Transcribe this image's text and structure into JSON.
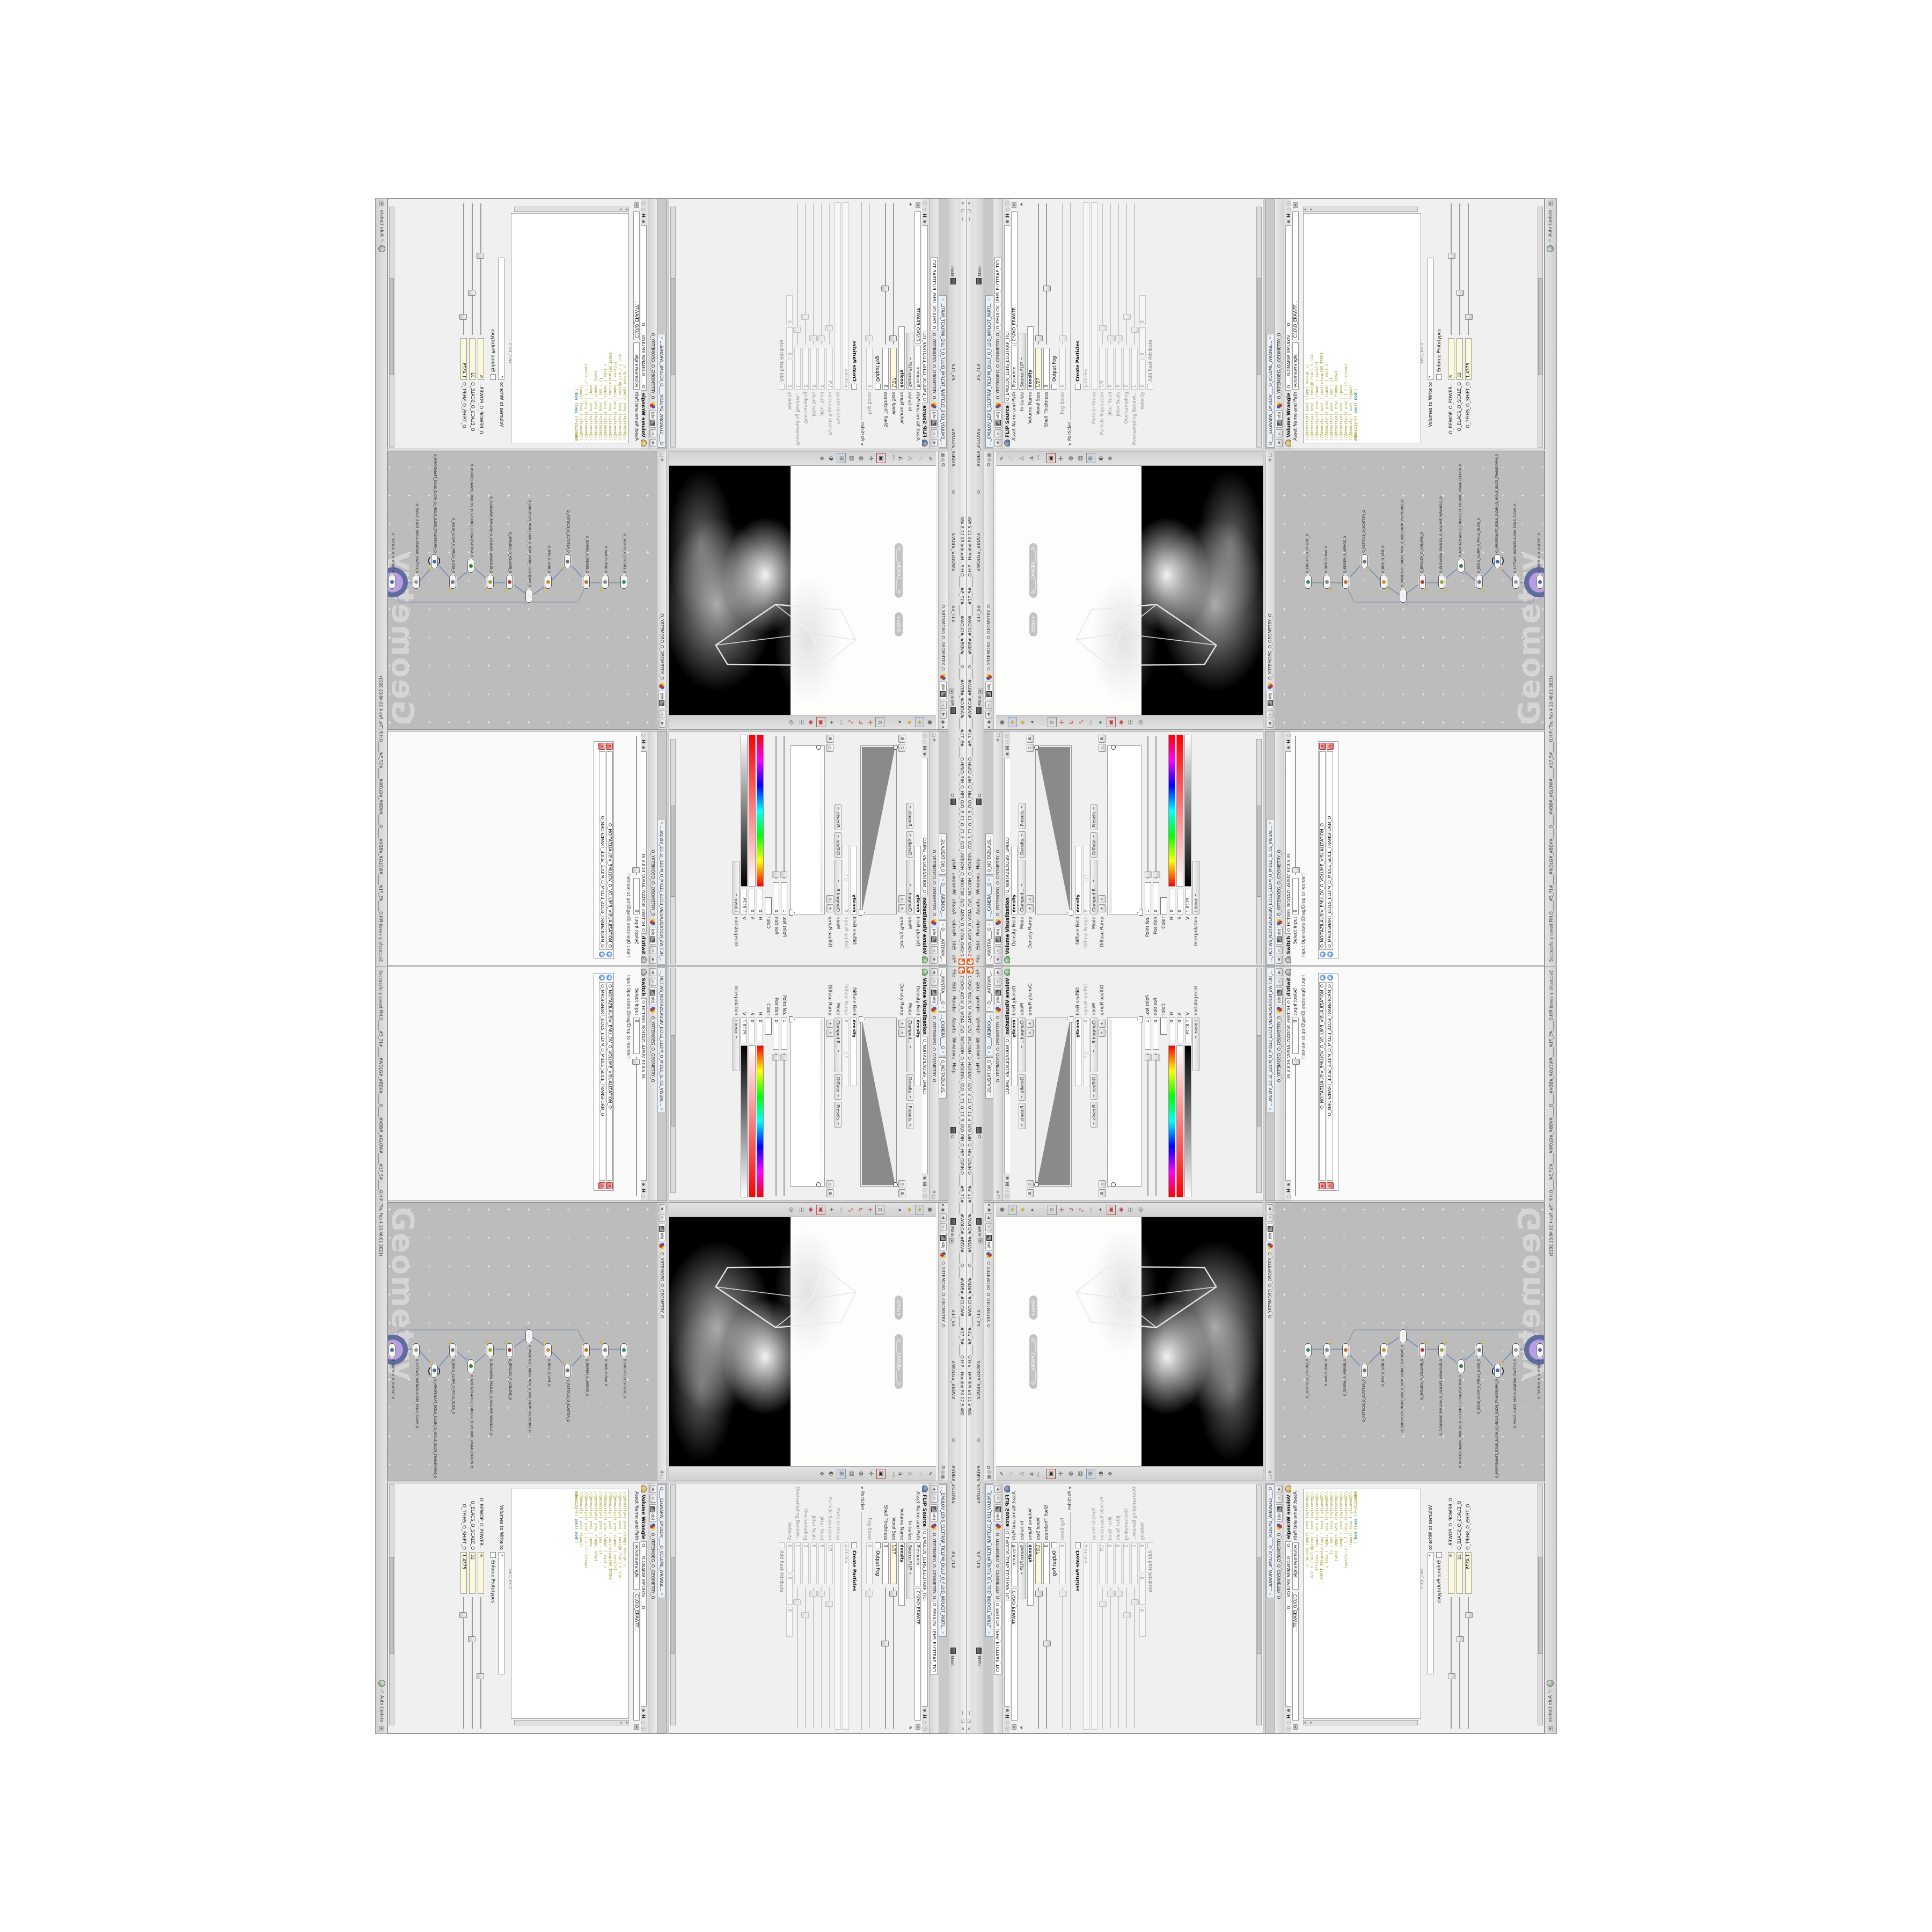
{
  "colors": {
    "orange": "#e8641b",
    "halo_outer": "#5e6c9e",
    "halo_inner": "#b79ee0",
    "code": "#9d9d29",
    "code_keyword": "#2e8fa3",
    "yellow_field": "#fcf9d8",
    "net_bg": "#bcbcbc",
    "accent_tab": "#e9f0f7"
  },
  "title": {
    "text": "C:\\O\\O_AIDIV_O_VIDIA_O\\O_INIDUOH_O_HOUDINI_O\\O_5_71_O_17_5_O\\O_PIH_O_HIP_O\\PIH.O_____#5_71#_____#WOLG#_#BDV#_____O_____#VDB#_#GLOW#_____#17_5#_____O.HIP – Houdini FX 17.5.480",
    "buttons": "―  ❏  ✕"
  },
  "menu": {
    "items": [
      "File",
      "Edit",
      "Render",
      "Assets",
      "Windows",
      "Help"
    ],
    "desktop_o": "O",
    "main": "Main",
    "tabs": [
      "#17_5#",
      "#WOLG#_#BDV#",
      "O",
      "#VDB#_#GLOW#",
      "#5_71#"
    ],
    "main2": "Main"
  },
  "status": {
    "message": "Successfully saved PIH.O_____#5_71#_____#WOLG#_#BDV#_____O_____#VDB#_#GLOW#_____#17_5#_____O.HIP (Thu Feb 4 10:46:01 2021)",
    "cook_mode": "Auto Update"
  },
  "breadcrumb": {
    "context": "obj",
    "path": "O_YRTEMOEG_O_GEOMETRY_O"
  },
  "volviz": {
    "tabs": [
      "..._MANTRA____O",
      "..._CAMERA____O",
      "O_NOITAZILAUS..."
    ],
    "node_type": "Volume Visualization",
    "node_name": "O_NOITAZILAUSIV_EMULO",
    "density_field_label": "Density Field",
    "density_field": "density",
    "mode_label": "Mode",
    "mode": "Clamped...",
    "group_density": "Density",
    "presets": "Presets",
    "density_ramp_label": "Density Ramp",
    "diffuse_field_label": "Diffuse Field",
    "diffuse_field": "density",
    "diffuse_range_label": "Diffuse Range",
    "diffuse_range_min": "0",
    "diffuse_range_max": "1",
    "mode2_label": "Mode",
    "mode2": "Clamped R...",
    "group_diffuse": "Diffuse",
    "presets2": "Presets",
    "diffuse_ramp_label": "Diffuse Ramp",
    "point_no_label": "Point No.",
    "point_no": "1",
    "position_label": "Position",
    "position": "0",
    "color_label": "Color",
    "h_label": "H",
    "h": "0",
    "s_label": "S",
    "s": "0",
    "v_label": "V",
    "v": "1.8125",
    "interp_label": "Interpolation",
    "interp": "Linear"
  },
  "viewport": {
    "pill_view": "Ortho",
    "pill_camera": "O_____CAMERA_____O"
  },
  "flip": {
    "tab": "..._EMULOV_LEHS_ELCITRAP_TICLPMI_DIULF_O_FLUID_IMPLICIT_PARTI...",
    "node_type": "FLIP Source",
    "node_name": "O_EMULOV_LEHS_ELCITRAP_TICI",
    "asset_label": "Asset Name and Path",
    "asset_name": "flipsource",
    "asset_path": "C:\\O\\O_ERAWTF...",
    "initialize_label": "Initialize",
    "initialize": "Source FLIP",
    "volume_name_label": "Volume Name",
    "volume_name": "density",
    "voxel_size_label": "Voxel Size",
    "voxel_size": "1/27",
    "shell_label": "Shell Thickness",
    "shell": "3",
    "output_fog_label": "Output Fog",
    "fog_boost_label": "Fog Boost",
    "fog_boost": "0",
    "particles_section": "Particles",
    "create_particles_label": "Create Particles",
    "particles_field": "particles",
    "particle_group_label": "Particle Group",
    "particle_group": "",
    "particle_sep_label": "Particle Separation",
    "particle_sep": "1/3",
    "jitter_seed_label": "Jitter Seed",
    "jitter_seed": "0",
    "jitter_scale_label": "Jitter Scale",
    "jitter_scale": "0",
    "oversampling_label": "Oversampling",
    "oversampling": "2",
    "oversampling_bw_label": "Oversampling Bandwi...",
    "oversampling_bw": "1",
    "velocity_label": "Velocity",
    "vx": "0",
    "vy": "0",
    "vz": "0",
    "add_rest_label": "Add Rest Attribute"
  },
  "switchp": {
    "tab": "..._HCTIWS_NOITAZILAUSIV_ECILS_ELDIM_O_MIDLE_SLICE_VISUAL...",
    "node_type": "Switch",
    "node_name": "O_HCTIWS_NOITAZILAUSIV_ECILS_EL",
    "select_input_label": "Select Input",
    "select_input": "0",
    "list_label": "Input Operators (Drag/Drop to reorder)",
    "inputs": [
      "O_NOITAZILAUSIV_EMULOV_O_VOLUME_VISUALIZATION_O",
      "O_MROFSNART_ECILS_ELDIM_O_MIDLE_SLICE_TRANSFORM_O"
    ]
  },
  "network": {
    "watermark": "Geometry",
    "nodes": [
      {
        "label": "O_EREHPS_O_SPHERE_O"
      },
      {
        "label": "O_XOB_O_BOX_O"
      },
      {
        "label": "O_EGREM_O_MERGE_O"
      },
      {
        "label": "O_RETTACS_O_SCATTER_O"
      },
      {
        "label": "O_BDV_O_VDB_O"
      },
      {
        "label": "O_SNOGYLOP_MORF_BDV_O_VDB_FROM_POLYGONS_O"
      },
      {
        "label": "O_EMULOV_O_VOLUME_O"
      },
      {
        "label": "O_ELGNARW_EMULOV_O_VOLUME_WRANGLE_O"
      },
      {
        "label": "O_NOITAZILAUSIV_EMULOV_O_VOLUME_VISUALIZATION_O"
      },
      {
        "label": "O_ECILS_ELDIM_O_MIDLE_SLICE_O"
      },
      {
        "label": "O_MROFSNART_ECILS_ELDIM_O_MIDLE_SLICE_TRANSFORM_O"
      },
      {
        "label": "O_HCTIWS_NOITAZILAUSIV_ECILS_ELDIM_O"
      },
      {
        "label": "O_TUPTUO_O_OUTPUT_O"
      }
    ]
  },
  "wrangle": {
    "tab": "O____ELGNARW_EMULOV____O_VOLUME_WRANGL...",
    "node_type": "Volume Wrangle",
    "node_name": "O____ELGNARW_EMULOV____O",
    "asset_label": "Asset Name and Path",
    "asset_name": "volumewrangle",
    "asset_path": "C:\\O\\O_ERAWTF...",
    "code": [
      "//@density=( pow( clamp( cos(@O_EL",
      "//@density=( pow( ( cos(@O_ELACS_O_SCAL",
      "//@density=(( pow( clamp( ( cos(1*$",
      "//@density=( pow( ( cos((clamp(@O_TFIHS",
      "//@density=(( pow( clamp( ( cos( c",
      "//@density=( pow( ( cos ( cl",
      "//@density=(( pow( clamp( )pow(",
      "//@density=( pow( ( )pow(",
      "//@density=(( pow(( 1./ (1.-clamp(",
      "//@density=( pow( ))pow((",
      ""
    ],
    "code_last_a": "@density=(( ",
    "code_last_kw1": "pow",
    "code_last_b": "(( ",
    "code_last_kw2": "mod",
    "code_last_c": "((",
    "lncol": "Ln 1, Col 1",
    "volumes_label": "Volumes to Write to",
    "volumes": "*",
    "enforce_label": "Enforce Prototypes",
    "spare": [
      {
        "label": "O_REWOP_O_POWER...",
        "value": "6"
      },
      {
        "label": "O_ELACS_O_SCALE_O",
        "value": "32"
      },
      {
        "label": "O_TFIHS_O_SHIFT_O",
        "value": "1.4375"
      }
    ]
  }
}
